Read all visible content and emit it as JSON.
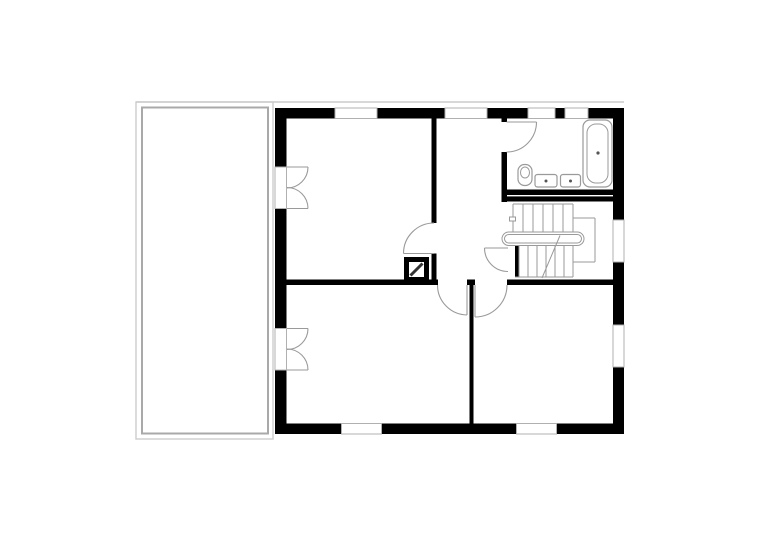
{
  "meta": {
    "title": "upper-floor-plan",
    "canvas": {
      "width": 780,
      "height": 551,
      "background": "#ffffff"
    }
  },
  "palette": {
    "wall": "#000000",
    "terrace_outer": "#cccccc",
    "terrace_inner": "#a9a9a9",
    "window_frame": "#b0b0b0",
    "fixture_stroke": "#9a9a9a",
    "chimney_line": "#333333",
    "drain_dot": "#555555"
  },
  "drawing": {
    "elements": [
      {
        "name": "eaves-line",
        "type": "line",
        "x1": 136,
        "y1": 102,
        "x2": 624,
        "y2": 102,
        "stroke": "#cccccc",
        "sw": 1.4
      },
      {
        "name": "terrace-outer",
        "type": "rect",
        "x": 136,
        "y": 102,
        "w": 137,
        "h": 337,
        "stroke": "#cccccc",
        "sw": 1.4,
        "fill": "none"
      },
      {
        "name": "terrace-inner",
        "type": "rect",
        "x": 142,
        "y": 107.5,
        "w": 126,
        "h": 326,
        "stroke": "#a9a9a9",
        "sw": 2,
        "fill": "none"
      },
      {
        "name": "wall-top-1",
        "type": "rect",
        "x": 275,
        "y": 108,
        "w": 60,
        "h": 10.5,
        "fill": "#000000"
      },
      {
        "name": "wall-top-2",
        "type": "rect",
        "x": 377,
        "y": 108,
        "w": 68,
        "h": 10.5,
        "fill": "#000000"
      },
      {
        "name": "wall-top-3",
        "type": "rect",
        "x": 487,
        "y": 108,
        "w": 41,
        "h": 10.5,
        "fill": "#000000"
      },
      {
        "name": "wall-top-pier",
        "type": "rect",
        "x": 555,
        "y": 108,
        "w": 10,
        "h": 10.5,
        "fill": "#000000"
      },
      {
        "name": "wall-top-4",
        "type": "rect",
        "x": 588,
        "y": 108,
        "w": 36,
        "h": 10.5,
        "fill": "#000000"
      },
      {
        "name": "wall-left-1",
        "type": "rect",
        "x": 275,
        "y": 108,
        "w": 11.5,
        "h": 59,
        "fill": "#000000"
      },
      {
        "name": "wall-left-2",
        "type": "rect",
        "x": 275,
        "y": 208.5,
        "w": 11.5,
        "h": 120,
        "fill": "#000000"
      },
      {
        "name": "wall-left-3",
        "type": "rect",
        "x": 275,
        "y": 370,
        "w": 11.5,
        "h": 63.5,
        "fill": "#000000"
      },
      {
        "name": "wall-right-1",
        "type": "rect",
        "x": 613,
        "y": 108,
        "w": 11,
        "h": 112,
        "fill": "#000000"
      },
      {
        "name": "wall-right-2",
        "type": "rect",
        "x": 613,
        "y": 262,
        "w": 11,
        "h": 63,
        "fill": "#000000"
      },
      {
        "name": "wall-right-3",
        "type": "rect",
        "x": 613,
        "y": 367,
        "w": 11,
        "h": 67,
        "fill": "#000000"
      },
      {
        "name": "wall-bottom-1",
        "type": "rect",
        "x": 275,
        "y": 423.5,
        "w": 66.5,
        "h": 10.5,
        "fill": "#000000"
      },
      {
        "name": "wall-bottom-2",
        "type": "rect",
        "x": 381.5,
        "y": 423.5,
        "w": 135,
        "h": 10.5,
        "fill": "#000000"
      },
      {
        "name": "wall-bottom-3",
        "type": "rect",
        "x": 556.5,
        "y": 423.5,
        "w": 67.5,
        "h": 10.5,
        "fill": "#000000"
      },
      {
        "name": "window-top-1",
        "type": "rect",
        "x": 335,
        "y": 108,
        "w": 42,
        "h": 10.5,
        "stroke": "#b0b0b0",
        "sw": 1,
        "fill": "#ffffff"
      },
      {
        "name": "window-top-2",
        "type": "rect",
        "x": 445,
        "y": 108,
        "w": 42,
        "h": 10.5,
        "stroke": "#b0b0b0",
        "sw": 1,
        "fill": "#ffffff"
      },
      {
        "name": "window-top-3",
        "type": "rect",
        "x": 528,
        "y": 108,
        "w": 27,
        "h": 10.5,
        "stroke": "#b0b0b0",
        "sw": 1,
        "fill": "#ffffff"
      },
      {
        "name": "window-top-4",
        "type": "rect",
        "x": 565,
        "y": 108,
        "w": 23,
        "h": 10.5,
        "stroke": "#b0b0b0",
        "sw": 1,
        "fill": "#ffffff"
      },
      {
        "name": "window-right-1",
        "type": "rect",
        "x": 613,
        "y": 220,
        "w": 11,
        "h": 42,
        "stroke": "#b0b0b0",
        "sw": 1,
        "fill": "#ffffff"
      },
      {
        "name": "window-right-2",
        "type": "rect",
        "x": 613,
        "y": 325,
        "w": 11,
        "h": 42,
        "stroke": "#b0b0b0",
        "sw": 1,
        "fill": "#ffffff"
      },
      {
        "name": "window-bottom-1",
        "type": "rect",
        "x": 341.5,
        "y": 423.5,
        "w": 40,
        "h": 10.5,
        "stroke": "#b0b0b0",
        "sw": 1,
        "fill": "#ffffff"
      },
      {
        "name": "window-bottom-2",
        "type": "rect",
        "x": 516.5,
        "y": 423.5,
        "w": 40,
        "h": 10.5,
        "stroke": "#b0b0b0",
        "sw": 1,
        "fill": "#ffffff"
      },
      {
        "name": "french-door-opening-1",
        "type": "rect",
        "x": 275,
        "y": 167,
        "w": 11.5,
        "h": 41.5,
        "stroke": "#b0b0b0",
        "sw": 1,
        "fill": "#ffffff"
      },
      {
        "name": "french-door-opening-2",
        "type": "rect",
        "x": 275,
        "y": 328.5,
        "w": 11.5,
        "h": 41.5,
        "stroke": "#b0b0b0",
        "sw": 1,
        "fill": "#ffffff"
      },
      {
        "name": "wall-interior-room1",
        "type": "rect",
        "x": 431.5,
        "y": 118,
        "w": 5,
        "h": 105,
        "fill": "#000000"
      },
      {
        "name": "wall-interior-room1-stub",
        "type": "rect",
        "x": 431.5,
        "y": 253.5,
        "w": 5,
        "h": 31.5,
        "fill": "#000000"
      },
      {
        "name": "wall-bathroom-left-stub",
        "type": "rect",
        "x": 501.5,
        "y": 118,
        "w": 5.5,
        "h": 4,
        "fill": "#000000"
      },
      {
        "name": "wall-bathroom-left",
        "type": "rect",
        "x": 501.5,
        "y": 152,
        "w": 5.5,
        "h": 50,
        "fill": "#000000"
      },
      {
        "name": "wall-bathroom-bottom",
        "type": "rect",
        "x": 501.5,
        "y": 189.5,
        "w": 111.5,
        "h": 12,
        "fill": "#000000"
      },
      {
        "name": "wall-bathroom-bottom-gap",
        "type": "rect",
        "x": 507,
        "y": 195,
        "w": 106,
        "h": 1.4,
        "fill": "#ffffff"
      },
      {
        "name": "wall-middle-1",
        "type": "rect",
        "x": 286.5,
        "y": 279.5,
        "w": 151.5,
        "h": 5.5,
        "fill": "#000000"
      },
      {
        "name": "wall-middle-pier",
        "type": "rect",
        "x": 467,
        "y": 279.5,
        "w": 8,
        "h": 5.5,
        "fill": "#000000"
      },
      {
        "name": "wall-middle-2",
        "type": "rect",
        "x": 507,
        "y": 279.5,
        "w": 106,
        "h": 5.5,
        "fill": "#000000"
      },
      {
        "name": "wall-divider-bottom-rooms",
        "type": "rect",
        "x": 469.5,
        "y": 285,
        "w": 4,
        "h": 138.5,
        "fill": "#000000"
      },
      {
        "name": "stair-wall-bar",
        "type": "rect",
        "x": 515,
        "y": 245.5,
        "w": 4,
        "h": 31.5,
        "fill": "#000000"
      },
      {
        "name": "stair-edge-top",
        "type": "line",
        "x1": 513,
        "y1": 204,
        "x2": 573,
        "y2": 204,
        "stroke": "#9a9a9a",
        "sw": 1
      },
      {
        "name": "stair-tread-u1",
        "type": "line",
        "x1": 513,
        "y1": 204,
        "x2": 513,
        "y2": 231.5,
        "stroke": "#9a9a9a",
        "sw": 1
      },
      {
        "name": "stair-tread-u2",
        "type": "line",
        "x1": 523,
        "y1": 204,
        "x2": 523,
        "y2": 231.5,
        "stroke": "#9a9a9a",
        "sw": 1
      },
      {
        "name": "stair-tread-u3",
        "type": "line",
        "x1": 533,
        "y1": 204,
        "x2": 533,
        "y2": 231.5,
        "stroke": "#9a9a9a",
        "sw": 1
      },
      {
        "name": "stair-tread-u4",
        "type": "line",
        "x1": 543,
        "y1": 204,
        "x2": 543,
        "y2": 231.5,
        "stroke": "#9a9a9a",
        "sw": 1
      },
      {
        "name": "stair-tread-u5",
        "type": "line",
        "x1": 553,
        "y1": 204,
        "x2": 553,
        "y2": 231.5,
        "stroke": "#9a9a9a",
        "sw": 1
      },
      {
        "name": "stair-tread-u6",
        "type": "line",
        "x1": 563,
        "y1": 204,
        "x2": 563,
        "y2": 231.5,
        "stroke": "#9a9a9a",
        "sw": 1
      },
      {
        "name": "stair-tread-u7",
        "type": "line",
        "x1": 573,
        "y1": 204,
        "x2": 573,
        "y2": 231.5,
        "stroke": "#9a9a9a",
        "sw": 1
      },
      {
        "name": "stair-landing-top",
        "type": "line",
        "x1": 573,
        "y1": 218,
        "x2": 595,
        "y2": 218,
        "stroke": "#9a9a9a",
        "sw": 1
      },
      {
        "name": "stair-landing-right",
        "type": "line",
        "x1": 595,
        "y1": 218,
        "x2": 595,
        "y2": 262,
        "stroke": "#9a9a9a",
        "sw": 1
      },
      {
        "name": "stair-landing-bottom",
        "type": "line",
        "x1": 573,
        "y1": 262,
        "x2": 595,
        "y2": 262,
        "stroke": "#9a9a9a",
        "sw": 1
      },
      {
        "name": "stair-tread-l1",
        "type": "line",
        "x1": 519,
        "y1": 246,
        "x2": 519,
        "y2": 277,
        "stroke": "#9a9a9a",
        "sw": 1
      },
      {
        "name": "stair-tread-l2",
        "type": "line",
        "x1": 528,
        "y1": 246,
        "x2": 528,
        "y2": 277,
        "stroke": "#9a9a9a",
        "sw": 1
      },
      {
        "name": "stair-tread-l3",
        "type": "line",
        "x1": 537,
        "y1": 246,
        "x2": 537,
        "y2": 277,
        "stroke": "#9a9a9a",
        "sw": 1
      },
      {
        "name": "stair-tread-l4",
        "type": "line",
        "x1": 546,
        "y1": 246,
        "x2": 546,
        "y2": 277,
        "stroke": "#9a9a9a",
        "sw": 1
      },
      {
        "name": "stair-tread-l5",
        "type": "line",
        "x1": 555,
        "y1": 246,
        "x2": 555,
        "y2": 277,
        "stroke": "#9a9a9a",
        "sw": 1
      },
      {
        "name": "stair-tread-l6",
        "type": "line",
        "x1": 564,
        "y1": 246,
        "x2": 564,
        "y2": 277,
        "stroke": "#9a9a9a",
        "sw": 1
      },
      {
        "name": "stair-tread-l7",
        "type": "line",
        "x1": 573,
        "y1": 246,
        "x2": 573,
        "y2": 277,
        "stroke": "#9a9a9a",
        "sw": 1
      },
      {
        "name": "stair-edge-bottom",
        "type": "line",
        "x1": 515,
        "y1": 277,
        "x2": 573,
        "y2": 277,
        "stroke": "#9a9a9a",
        "sw": 1
      },
      {
        "name": "stair-start-marker",
        "type": "rect",
        "x": 509.5,
        "y": 217,
        "w": 6,
        "h": 4,
        "stroke": "#9a9a9a",
        "sw": 1,
        "fill": "#ffffff"
      },
      {
        "name": "stair-handrail-outer",
        "type": "rect",
        "x": 502,
        "y": 232,
        "w": 82,
        "h": 13.5,
        "rx": 6.75,
        "stroke": "#9a9a9a",
        "sw": 1,
        "fill": "#ffffff"
      },
      {
        "name": "stair-handrail-inner",
        "type": "rect",
        "x": 504.5,
        "y": 234.5,
        "w": 77,
        "h": 8.5,
        "rx": 4.25,
        "stroke": "#9a9a9a",
        "sw": 1,
        "fill": "none"
      },
      {
        "name": "stair-walk-line",
        "type": "line",
        "x1": 542,
        "y1": 278,
        "x2": 560,
        "y2": 235.5,
        "stroke": "#9a9a9a",
        "sw": 1
      },
      {
        "name": "chimney-outer",
        "type": "rect",
        "x": 404,
        "y": 257,
        "w": 25,
        "h": 25,
        "fill": "#000000"
      },
      {
        "name": "chimney-inner",
        "type": "rect",
        "x": 409,
        "y": 262,
        "w": 15,
        "h": 15,
        "fill": "#ffffff"
      },
      {
        "name": "chimney-flue-line",
        "type": "line",
        "x1": 410.5,
        "y1": 275.5,
        "x2": 422.5,
        "y2": 263.5,
        "stroke": "#333333",
        "sw": 3
      },
      {
        "name": "bathtub-outer",
        "type": "rect",
        "x": 583,
        "y": 120,
        "w": 29,
        "h": 67,
        "rx": 7,
        "stroke": "#9a9a9a",
        "sw": 1.2,
        "fill": "#ffffff"
      },
      {
        "name": "bathtub-inner",
        "type": "rect",
        "x": 587,
        "y": 124,
        "w": 21,
        "h": 59,
        "rx": 9,
        "stroke": "#9a9a9a",
        "sw": 1,
        "fill": "none"
      },
      {
        "name": "bathtub-drain",
        "type": "circle",
        "cx": 598,
        "cy": 153,
        "r": 1.6,
        "fill": "#555555"
      },
      {
        "name": "toilet-body",
        "type": "rect",
        "x": 518,
        "y": 164.5,
        "w": 14,
        "h": 21,
        "rx": 6.5,
        "stroke": "#9a9a9a",
        "sw": 1.2,
        "fill": "#ffffff"
      },
      {
        "name": "toilet-bowl",
        "type": "ellipse",
        "cx": 525,
        "cy": 172.5,
        "rx": 4.5,
        "ry": 5.5,
        "stroke": "#9a9a9a",
        "sw": 1,
        "fill": "none"
      },
      {
        "name": "sink-1",
        "type": "rect",
        "x": 535,
        "y": 174.5,
        "w": 22,
        "h": 12.5,
        "rx": 2.5,
        "stroke": "#9a9a9a",
        "sw": 1.2,
        "fill": "#ffffff"
      },
      {
        "name": "sink-1-drain",
        "type": "circle",
        "cx": 546,
        "cy": 181,
        "r": 1.5,
        "fill": "#555555"
      },
      {
        "name": "sink-2",
        "type": "rect",
        "x": 560.5,
        "y": 174.5,
        "w": 20,
        "h": 12.5,
        "rx": 2.5,
        "stroke": "#9a9a9a",
        "sw": 1.2,
        "fill": "#ffffff"
      },
      {
        "name": "sink-2-drain",
        "type": "circle",
        "cx": 570.5,
        "cy": 181,
        "r": 1.5,
        "fill": "#555555"
      },
      {
        "name": "french-door-1-leaf-top",
        "type": "line",
        "x1": 287,
        "y1": 167,
        "x2": 308,
        "y2": 167,
        "stroke": "#9a9a9a",
        "sw": 1.1
      },
      {
        "name": "french-door-1-arc-top",
        "type": "path",
        "d": "M 308 167 A 21 21 0 0 1 287 188",
        "stroke": "#9a9a9a",
        "sw": 1.1,
        "fill": "none"
      },
      {
        "name": "french-door-1-leaf-bottom",
        "type": "line",
        "x1": 287,
        "y1": 208.5,
        "x2": 308,
        "y2": 208.5,
        "stroke": "#9a9a9a",
        "sw": 1.1
      },
      {
        "name": "french-door-1-arc-bottom",
        "type": "path",
        "d": "M 308 208.5 A 21 21 0 0 0 287 187.5",
        "stroke": "#9a9a9a",
        "sw": 1.1,
        "fill": "none"
      },
      {
        "name": "french-door-2-leaf-top",
        "type": "line",
        "x1": 287,
        "y1": 328.5,
        "x2": 308,
        "y2": 328.5,
        "stroke": "#9a9a9a",
        "sw": 1.1
      },
      {
        "name": "french-door-2-arc-top",
        "type": "path",
        "d": "M 308 328.5 A 21 21 0 0 1 287 349.5",
        "stroke": "#9a9a9a",
        "sw": 1.1,
        "fill": "none"
      },
      {
        "name": "french-door-2-leaf-bottom",
        "type": "line",
        "x1": 287,
        "y1": 370,
        "x2": 308,
        "y2": 370,
        "stroke": "#9a9a9a",
        "sw": 1.1
      },
      {
        "name": "french-door-2-arc-bottom",
        "type": "path",
        "d": "M 308 370 A 21 21 0 0 0 287 349",
        "stroke": "#9a9a9a",
        "sw": 1.1,
        "fill": "none"
      },
      {
        "name": "bathroom-door-leaf",
        "type": "line",
        "x1": 506.5,
        "y1": 122,
        "x2": 536.5,
        "y2": 122,
        "stroke": "#9a9a9a",
        "sw": 1.1
      },
      {
        "name": "bathroom-door-arc",
        "type": "path",
        "d": "M 536.5 122 A 30 30 0 0 1 506.5 152",
        "stroke": "#9a9a9a",
        "sw": 1.1,
        "fill": "none"
      },
      {
        "name": "room1-door-leaf",
        "type": "line",
        "x1": 403.5,
        "y1": 253.5,
        "x2": 434,
        "y2": 253.5,
        "stroke": "#9a9a9a",
        "sw": 1.1
      },
      {
        "name": "room1-door-arc",
        "type": "path",
        "d": "M 434 223 A 30.5 30.5 0 0 0 403.5 253.5",
        "stroke": "#9a9a9a",
        "sw": 1.1,
        "fill": "none"
      },
      {
        "name": "stair-door-leaf",
        "type": "line",
        "x1": 484.5,
        "y1": 248,
        "x2": 508,
        "y2": 248,
        "stroke": "#9a9a9a",
        "sw": 1.1
      },
      {
        "name": "stair-door-arc",
        "type": "path",
        "d": "M 484.5 248 A 23.5 23.5 0 0 0 508 271.5",
        "stroke": "#9a9a9a",
        "sw": 1.1,
        "fill": "none"
      },
      {
        "name": "room2-door-leaf",
        "type": "line",
        "x1": 467,
        "y1": 285,
        "x2": 467,
        "y2": 315,
        "stroke": "#9a9a9a",
        "sw": 1.1
      },
      {
        "name": "room2-door-arc",
        "type": "path",
        "d": "M 437.5 285 A 30 30 0 0 0 467 315",
        "stroke": "#9a9a9a",
        "sw": 1.1,
        "fill": "none"
      },
      {
        "name": "room3-door-leaf",
        "type": "line",
        "x1": 475,
        "y1": 285,
        "x2": 475,
        "y2": 317,
        "stroke": "#9a9a9a",
        "sw": 1.1
      },
      {
        "name": "room3-door-arc",
        "type": "path",
        "d": "M 507 285 A 32 32 0 0 1 475 317",
        "stroke": "#9a9a9a",
        "sw": 1.1,
        "fill": "none"
      }
    ]
  }
}
